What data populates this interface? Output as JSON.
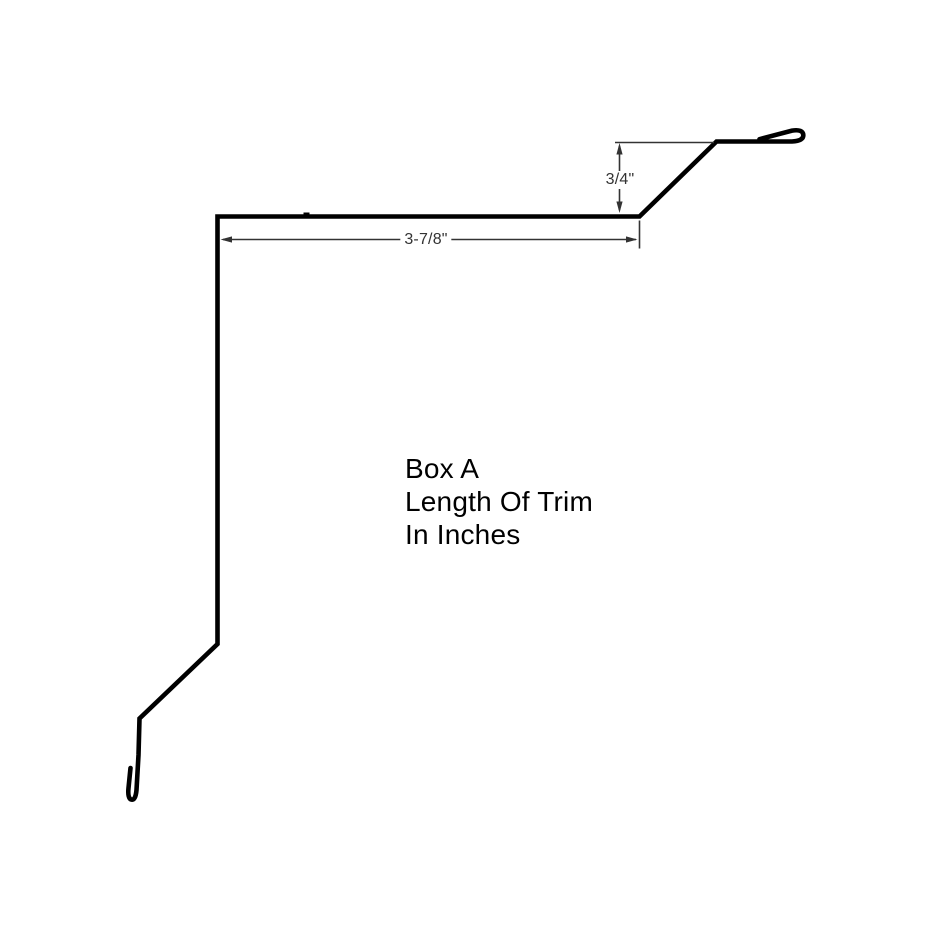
{
  "drawing": {
    "title": "Trim profile drawing",
    "note": {
      "lines": [
        "Box A",
        "Length Of Trim",
        "In Inches"
      ]
    },
    "dimensions": {
      "flange_height": {
        "value": "3/4\"",
        "orientation": "vertical"
      },
      "top_run": {
        "value": "3-7/8\"",
        "orientation": "horizontal"
      }
    },
    "colors": {
      "profile": "#000000",
      "dimension": "#333333",
      "background": "#ffffff"
    }
  }
}
